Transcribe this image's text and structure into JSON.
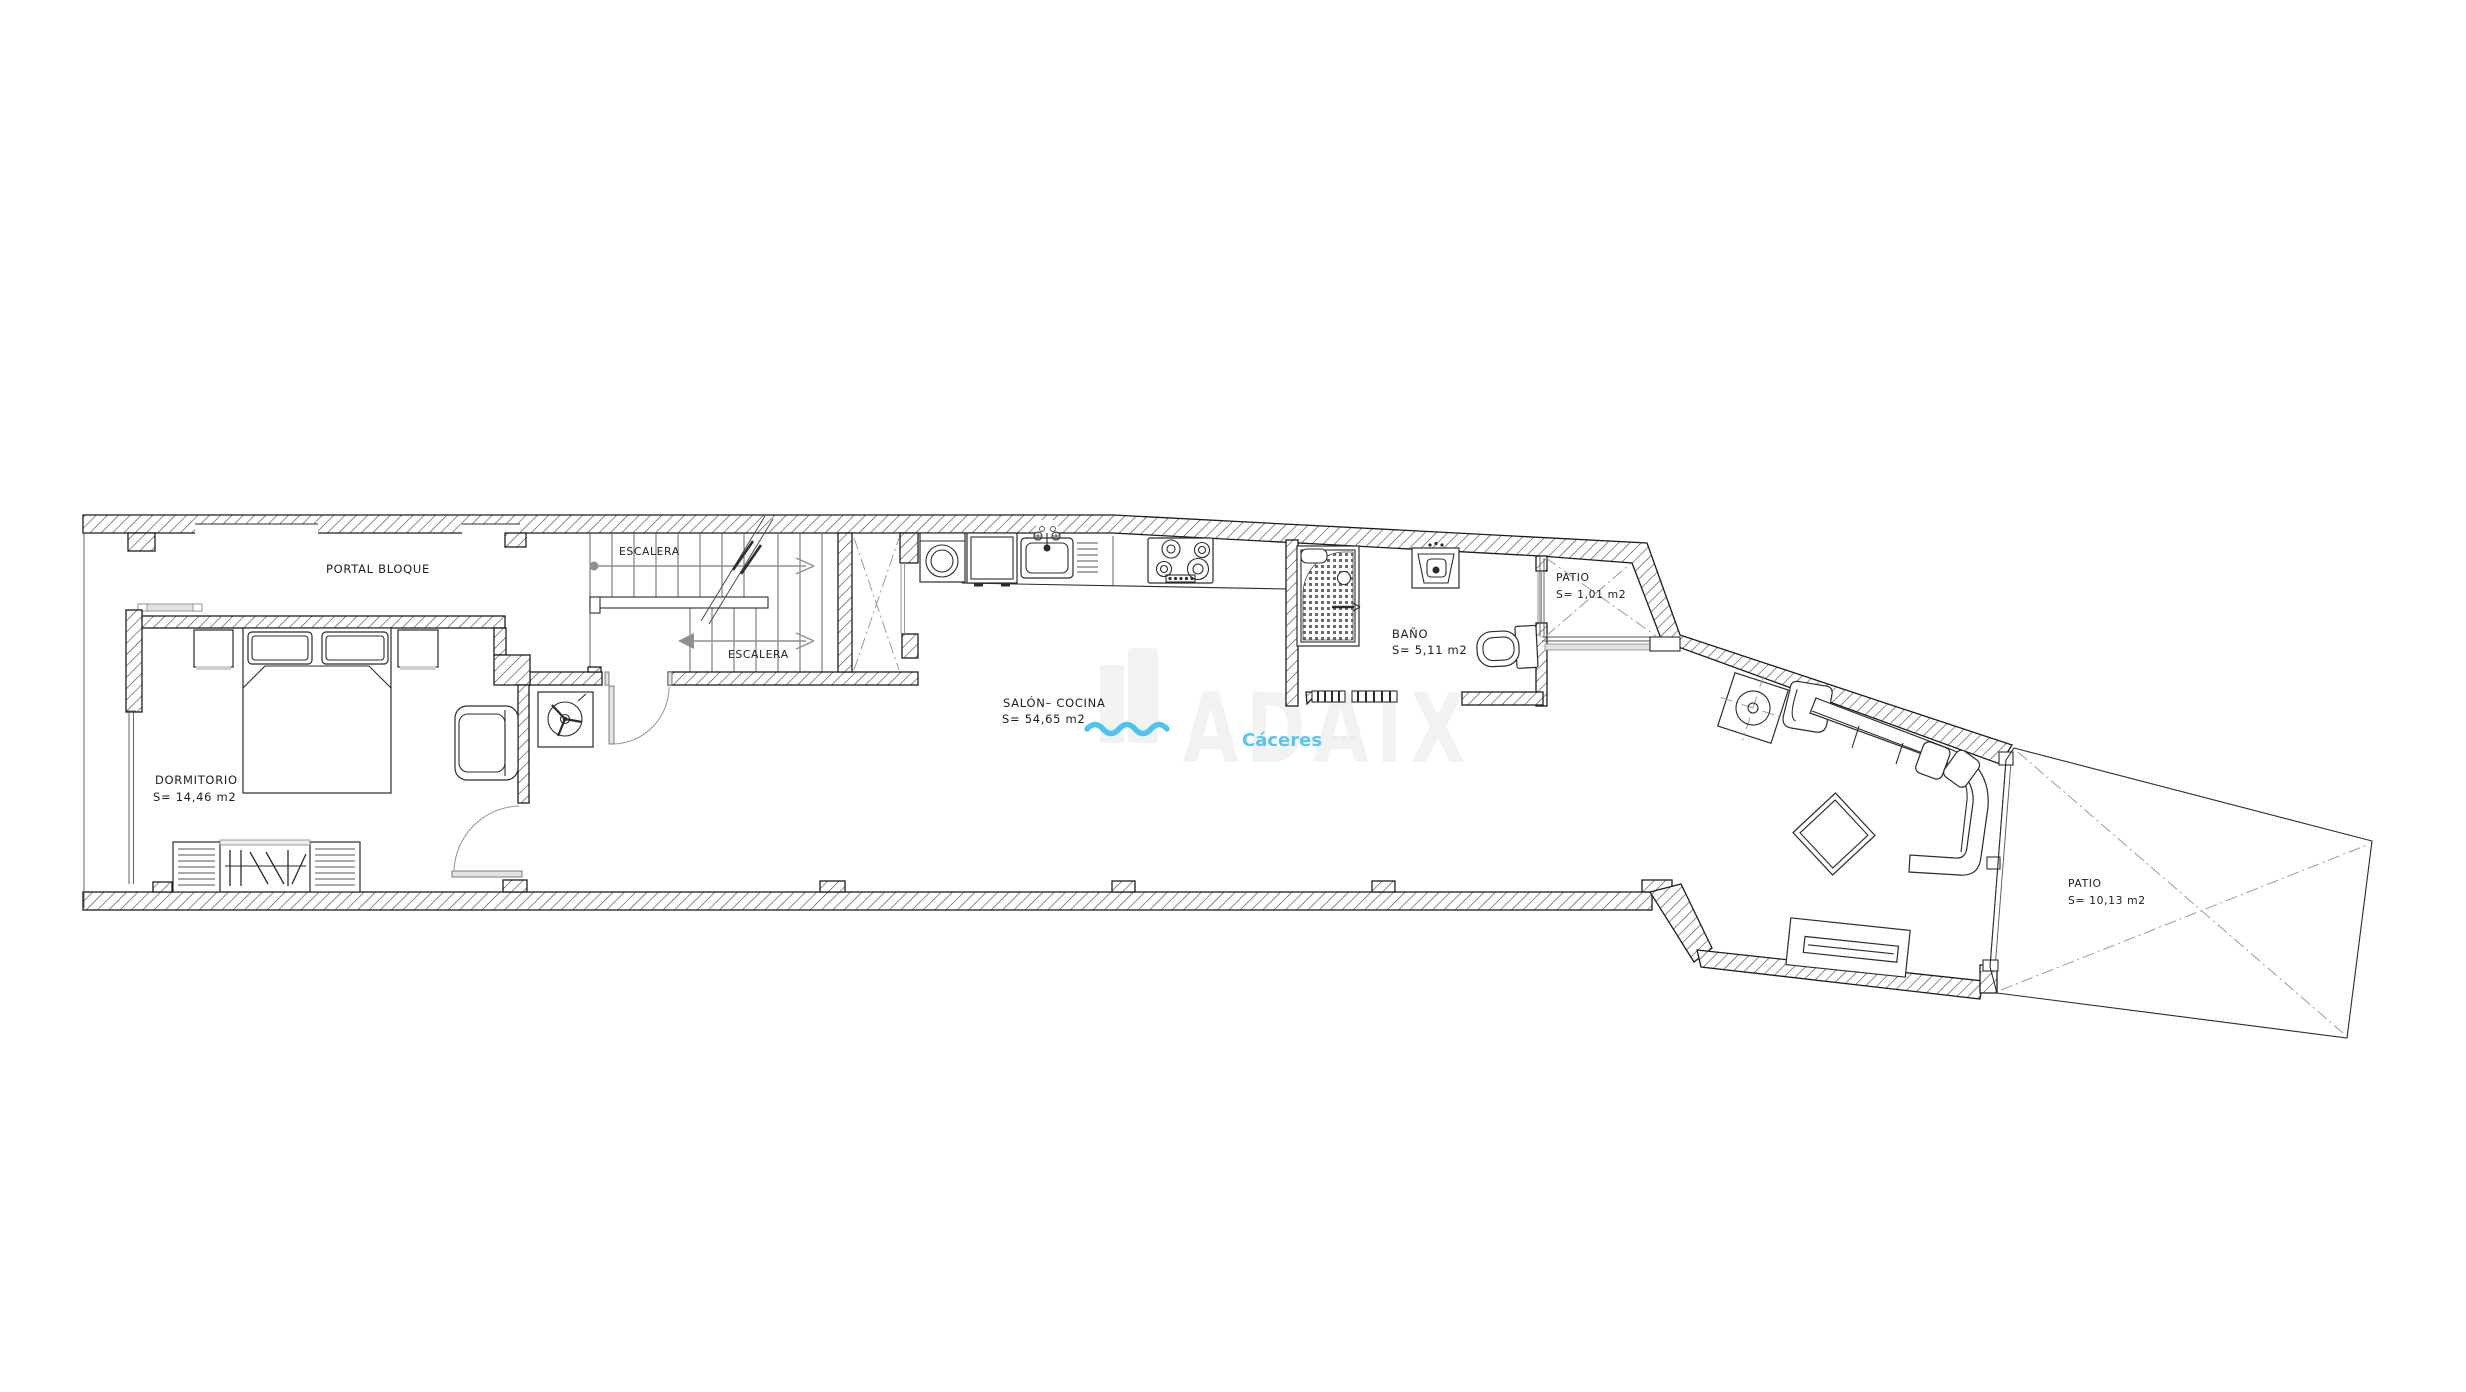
{
  "plan": {
    "portal_label": "PORTAL BLOQUE",
    "stairs": {
      "upper_label": "ESCALERA",
      "lower_label": "ESCALERA"
    },
    "rooms": {
      "dormitorio": {
        "name": "DORMITORIO",
        "area": "S= 14,46 m2"
      },
      "salon_cocina": {
        "name": "SALÓN– COCINA",
        "area": "S= 54,65 m2"
      },
      "bano": {
        "name": "BAÑO",
        "area": "S= 5,11 m2"
      },
      "patio_small": {
        "name": "PATIO",
        "area": "S= 1,01 m2"
      },
      "patio_large": {
        "name": "PATIO",
        "area": "S= 10,13 m2"
      }
    },
    "watermark": {
      "brand": "ADAIX",
      "city": "Cáceres"
    },
    "colors": {
      "line": "#1c1c1c",
      "hatch": "#414141",
      "dashdot": "#9b9b9b",
      "accent_blue": "#58c5ef",
      "squiggle_blue": "#4fc3ef",
      "watermark_gray": "#f2f2f2",
      "background": "#ffffff"
    }
  }
}
